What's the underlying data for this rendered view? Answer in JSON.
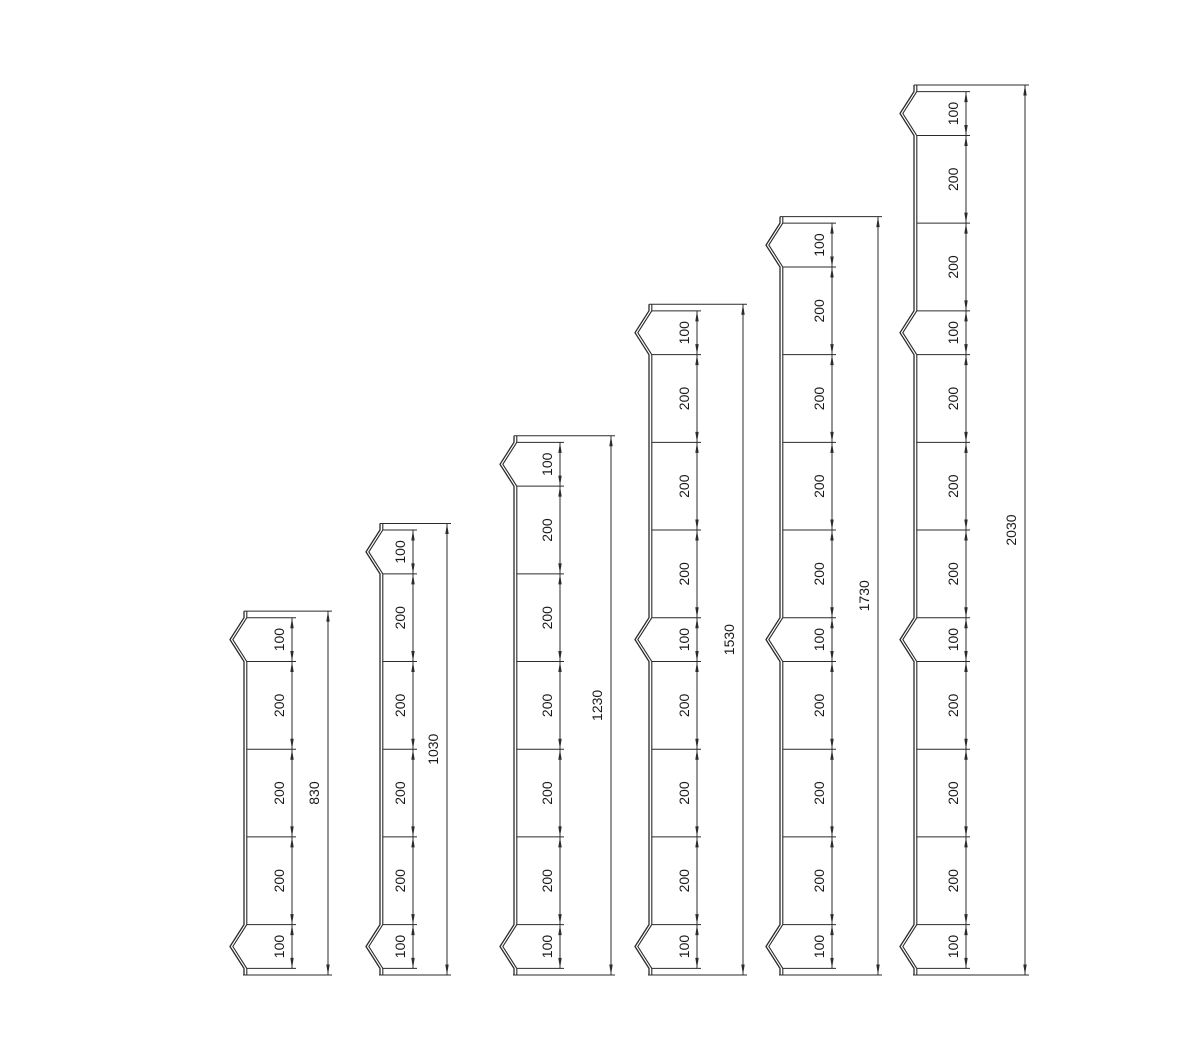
{
  "diagram": {
    "type": "technical-drawing",
    "description": "Six segmented post elevation profiles with chained segment dimensions and overall height dimensions",
    "colors": {
      "line": "#2b2b2b",
      "text": "#1a1a1a",
      "background": "#ffffff"
    },
    "posts": [
      {
        "overall_label": "830",
        "overall_value": 830,
        "segments": [
          {
            "label": "100",
            "value": 100,
            "notch": true
          },
          {
            "label": "200",
            "value": 200,
            "notch": false
          },
          {
            "label": "200",
            "value": 200,
            "notch": false
          },
          {
            "label": "200",
            "value": 200,
            "notch": false
          },
          {
            "label": "100",
            "value": 100,
            "notch": true
          }
        ],
        "layout": {
          "x": 244,
          "seg_dim_offset": 48,
          "overall_dim_offset": 84
        }
      },
      {
        "overall_label": "1030",
        "overall_value": 1030,
        "segments": [
          {
            "label": "100",
            "value": 100,
            "notch": true
          },
          {
            "label": "200",
            "value": 200,
            "notch": false
          },
          {
            "label": "200",
            "value": 200,
            "notch": false
          },
          {
            "label": "200",
            "value": 200,
            "notch": false
          },
          {
            "label": "200",
            "value": 200,
            "notch": false
          },
          {
            "label": "100",
            "value": 100,
            "notch": true
          }
        ],
        "layout": {
          "x": 380,
          "seg_dim_offset": 33,
          "overall_dim_offset": 67
        }
      },
      {
        "overall_label": "1230",
        "overall_value": 1230,
        "segments": [
          {
            "label": "100",
            "value": 100,
            "notch": true
          },
          {
            "label": "200",
            "value": 200,
            "notch": false
          },
          {
            "label": "200",
            "value": 200,
            "notch": false
          },
          {
            "label": "200",
            "value": 200,
            "notch": false
          },
          {
            "label": "200",
            "value": 200,
            "notch": false
          },
          {
            "label": "200",
            "value": 200,
            "notch": false
          },
          {
            "label": "100",
            "value": 100,
            "notch": true
          }
        ],
        "layout": {
          "x": 514,
          "seg_dim_offset": 46,
          "overall_dim_offset": 97
        }
      },
      {
        "overall_label": "1530",
        "overall_value": 1530,
        "segments": [
          {
            "label": "100",
            "value": 100,
            "notch": true
          },
          {
            "label": "200",
            "value": 200,
            "notch": false
          },
          {
            "label": "200",
            "value": 200,
            "notch": false
          },
          {
            "label": "200",
            "value": 200,
            "notch": false
          },
          {
            "label": "100",
            "value": 100,
            "notch": true
          },
          {
            "label": "200",
            "value": 200,
            "notch": false
          },
          {
            "label": "200",
            "value": 200,
            "notch": false
          },
          {
            "label": "200",
            "value": 200,
            "notch": false
          },
          {
            "label": "100",
            "value": 100,
            "notch": true
          }
        ],
        "layout": {
          "x": 649,
          "seg_dim_offset": 48,
          "overall_dim_offset": 94
        }
      },
      {
        "overall_label": "1730",
        "overall_value": 1730,
        "segments": [
          {
            "label": "100",
            "value": 100,
            "notch": true
          },
          {
            "label": "200",
            "value": 200,
            "notch": false
          },
          {
            "label": "200",
            "value": 200,
            "notch": false
          },
          {
            "label": "200",
            "value": 200,
            "notch": false
          },
          {
            "label": "200",
            "value": 200,
            "notch": false
          },
          {
            "label": "100",
            "value": 100,
            "notch": true
          },
          {
            "label": "200",
            "value": 200,
            "notch": false
          },
          {
            "label": "200",
            "value": 200,
            "notch": false
          },
          {
            "label": "200",
            "value": 200,
            "notch": false
          },
          {
            "label": "100",
            "value": 100,
            "notch": true
          }
        ],
        "layout": {
          "x": 780,
          "seg_dim_offset": 52,
          "overall_dim_offset": 98
        }
      },
      {
        "overall_label": "2030",
        "overall_value": 2030,
        "segments": [
          {
            "label": "100",
            "value": 100,
            "notch": true
          },
          {
            "label": "200",
            "value": 200,
            "notch": false
          },
          {
            "label": "200",
            "value": 200,
            "notch": false
          },
          {
            "label": "100",
            "value": 100,
            "notch": true
          },
          {
            "label": "200",
            "value": 200,
            "notch": false
          },
          {
            "label": "200",
            "value": 200,
            "notch": false
          },
          {
            "label": "200",
            "value": 200,
            "notch": false
          },
          {
            "label": "100",
            "value": 100,
            "notch": true
          },
          {
            "label": "200",
            "value": 200,
            "notch": false
          },
          {
            "label": "200",
            "value": 200,
            "notch": false
          },
          {
            "label": "200",
            "value": 200,
            "notch": false
          },
          {
            "label": "100",
            "value": 100,
            "notch": true
          }
        ],
        "layout": {
          "x": 914,
          "seg_dim_offset": 52,
          "overall_dim_offset": 111
        }
      }
    ]
  }
}
